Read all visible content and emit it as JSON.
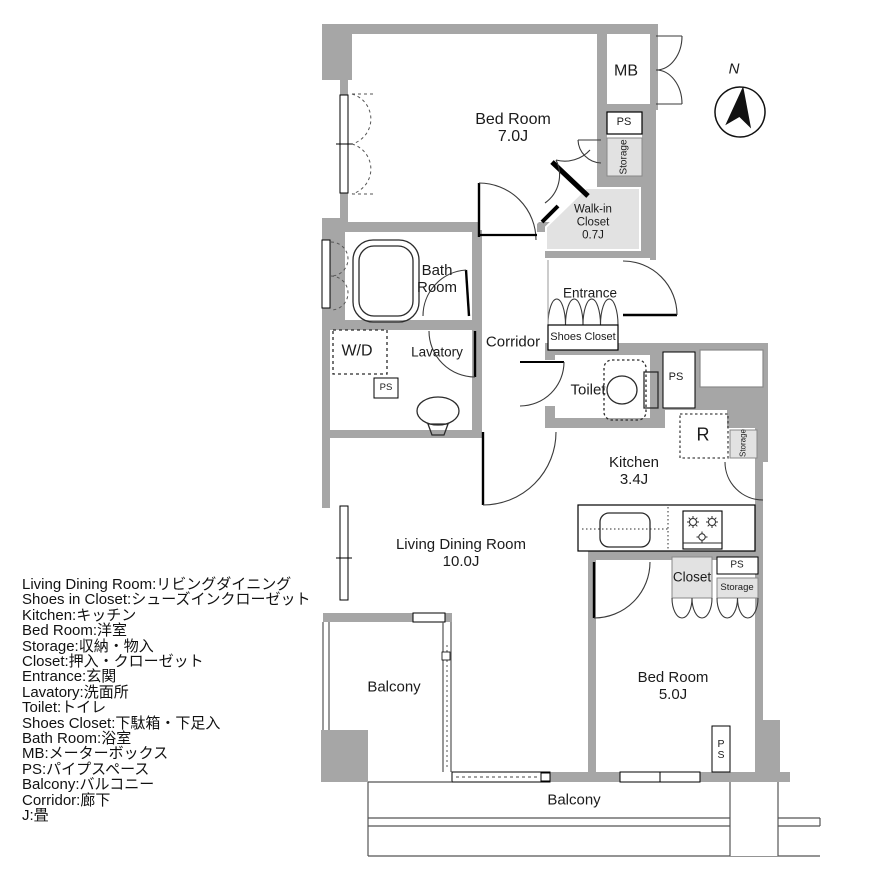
{
  "labels": {
    "bedroom1_name": "Bed Room",
    "bedroom1_size": "7.0J",
    "mb": "MB",
    "ps_top": "PS",
    "storage_top": "Storage",
    "wic_l1": "Walk-in",
    "wic_l2": "Closet",
    "wic_l3": "0.7J",
    "bath_l1": "Bath",
    "bath_l2": "Room",
    "wd": "W/D",
    "lavatory": "Lavatory",
    "ps_lavatory": "PS",
    "corridor": "Corridor",
    "entrance": "Entrance",
    "shoes_closet": "Shoes Closet",
    "toilet": "Toilet",
    "ps_toilet": "PS",
    "refrigerator": "R",
    "storage_kitchen": "Storage",
    "kitchen_name": "Kitchen",
    "kitchen_size": "3.4J",
    "closet": "Closet",
    "ps_closet": "PS",
    "storage_closet": "Storage",
    "ldk_name": "Living Dining Room",
    "ldk_size": "10.0J",
    "bedroom2_name": "Bed Room",
    "bedroom2_size": "5.0J",
    "balcony_left": "Balcony",
    "balcony_bottom": "Balcony",
    "ps_bottom": "PS",
    "compass_n": "N"
  },
  "legend": {
    "items": [
      "Living Dining Room:リビングダイニング",
      "Shoes in Closet:シューズインクローゼット",
      "Kitchen:キッチン",
      "Bed Room:洋室",
      "Storage:収納・物入",
      "Closet:押入・クローゼット",
      "Entrance:玄関",
      "Lavatory:洗面所",
      "Toilet:トイレ",
      "Shoes Closet:下駄箱・下足入",
      "Bath Room:浴室",
      "MB:メーターボックス",
      "PS:パイプスペース",
      "Balcony:バルコニー",
      "Corridor:廊下",
      "J:畳"
    ]
  },
  "colors": {
    "wall": "#a6a6a6",
    "light_room": "#e2e2e2",
    "line": "#2b2b2b"
  }
}
